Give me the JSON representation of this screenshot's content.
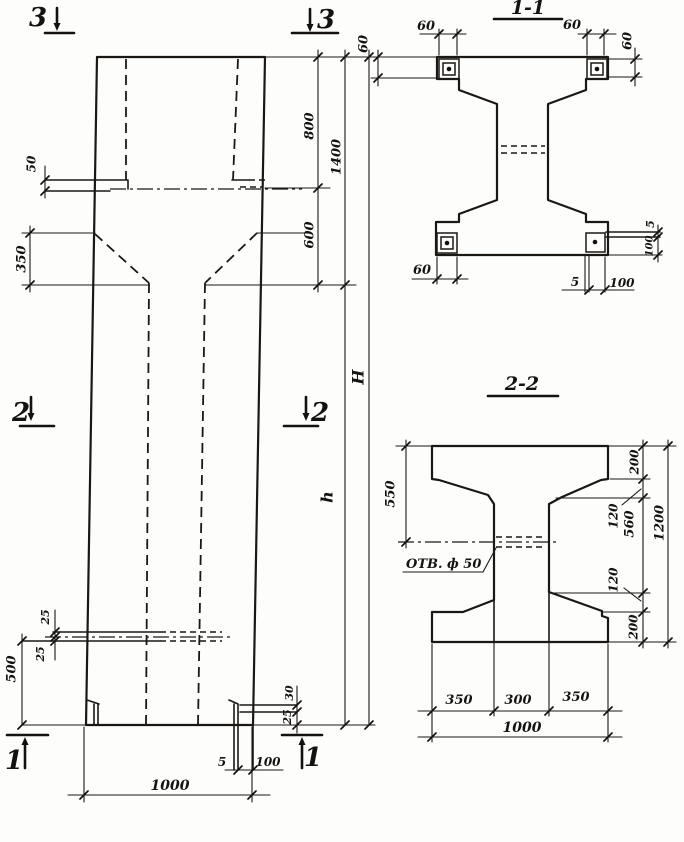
{
  "drawing": {
    "elevation": {
      "marker_top_left": "3",
      "marker_top_right": "3",
      "marker_mid_left": "2",
      "marker_mid_right": "2",
      "marker_bottom_left": "1",
      "marker_bottom_right": "1",
      "dim_ledge_thickness": "50",
      "dim_taper_height": "350",
      "dim_top_to_ledge": "800",
      "dim_ledge_to_shaft": "600",
      "dim_head_height": "1400",
      "dim_total_height": "H",
      "dim_shaft_height": "h",
      "dim_hole_upper": "25",
      "dim_hole_lower": "25",
      "dim_hole_above_base": "500",
      "dim_corner_upper": "30",
      "dim_corner_lower": "25",
      "dim_base_plate_gap": "5",
      "dim_base_plate_width": "100",
      "dim_column_width": "1000"
    },
    "section_1_1": {
      "title": "1-1",
      "dim_plate_top_left_width": "60",
      "dim_plate_top_left_height": "60",
      "dim_plate_top_right_width": "60",
      "dim_plate_top_right_height": "60",
      "dim_plate_bottom_left_width": "60",
      "dim_plate_side_thickness": "5",
      "dim_plate_side_length": "100",
      "dim_plate_bottom_gap": "5",
      "dim_plate_bottom_width": "100"
    },
    "section_2_2": {
      "title": "2-2",
      "hole_label": "ОТВ. ф 50",
      "dim_top_to_hole": "550",
      "dim_flange_top": "200",
      "dim_haunch_top": "120",
      "dim_web_height": "560",
      "dim_haunch_bottom": "120",
      "dim_flange_bottom": "200",
      "dim_total_depth": "1200",
      "dim_flange_left": "350",
      "dim_web_width": "300",
      "dim_flange_right": "350",
      "dim_total_width": "1000"
    }
  }
}
